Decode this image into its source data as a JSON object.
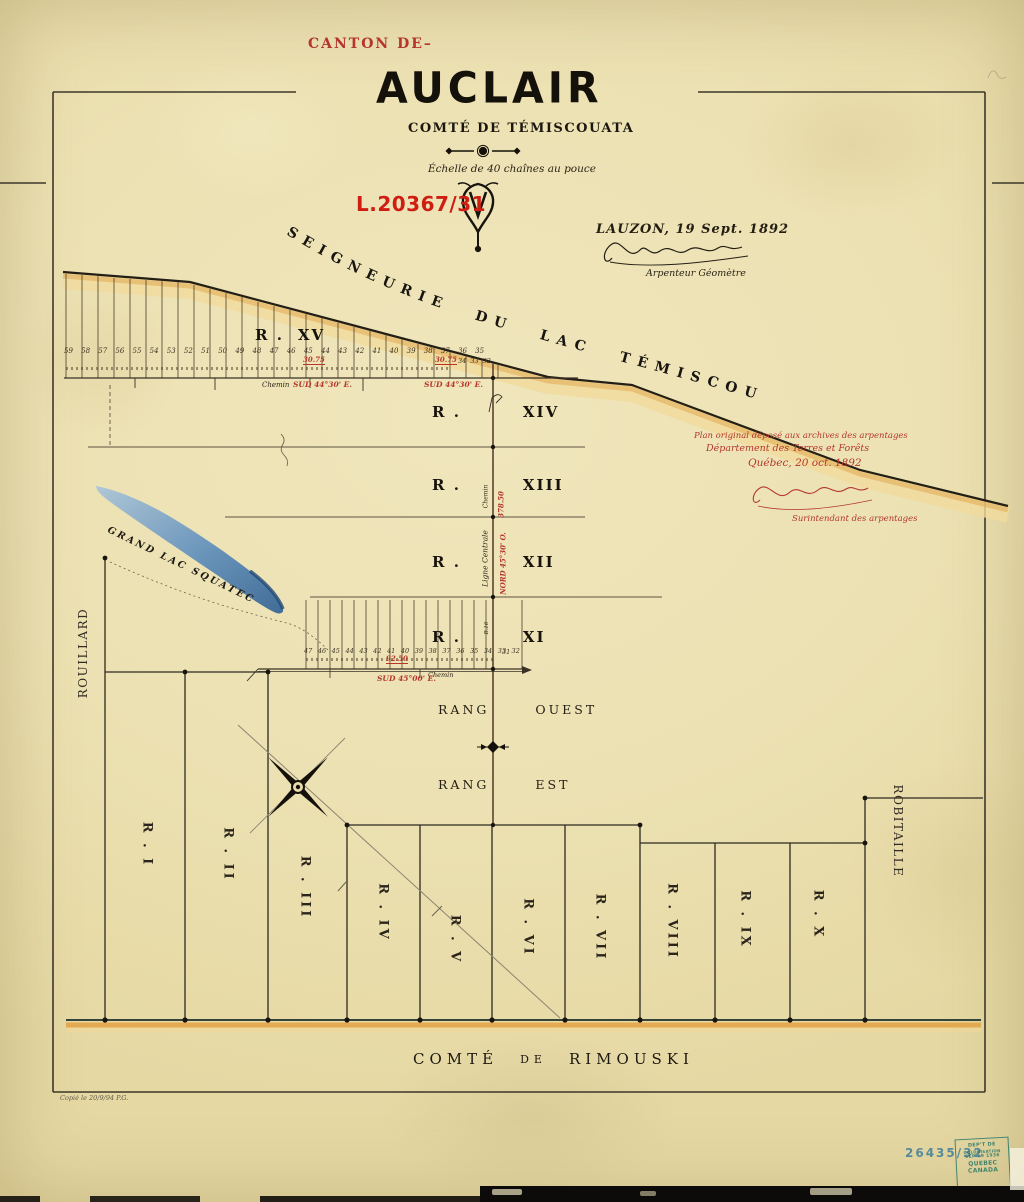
{
  "header": {
    "canton_label": "CANTON DE–",
    "name": "AUCLAIR",
    "county": "COMTÉ DE TÉMISCOUATA",
    "scale": "Échelle de 40 chaînes au pouce",
    "file_number": "L.20367/31",
    "place_date": "LAUZON, 19 Sept. 1892",
    "surveyor_title": "Arpenteur Géomètre"
  },
  "seigneurie_label": "SEIGNEURIE DU LAC TÉMISCOUATA",
  "archive": {
    "line1": "Plan original déposé aux archives des arpentages",
    "line2": "Département des Terres et Forêts",
    "line3": "Québec, 20 oct. 1892",
    "signer_title": "Surintendant des arpentages"
  },
  "upper_ranges": [
    {
      "prefix": "R .",
      "num": "XV"
    },
    {
      "prefix": "R .",
      "num": "XIV"
    },
    {
      "prefix": "R .",
      "num": "XIII"
    },
    {
      "prefix": "R .",
      "num": "XII"
    },
    {
      "prefix": "R .",
      "num": "XI"
    }
  ],
  "lots": {
    "r15_main": "59 58 57 56 55 54 53 52 51 50 49 48 47 46 45 44 43 42 41 40 39 38 37 36 35",
    "r15_tail": "34 33 32",
    "r11_main": "47 46 45 44 43 42 41 40 39 38 37 36 35 34 33 32",
    "r11_tail": "31"
  },
  "annot": {
    "r15_dist": "30.75",
    "r15_bearing": "SUD 44°30' E.",
    "r11_dist": "92.50",
    "r11_bearing": "SUD 45°00' E.",
    "center_dist": "378.50",
    "center_bearing": "NORD 45°30' O.",
    "ligne_centrale": "Ligne Centrale",
    "chemin": "Chemin",
    "b16": "B.16"
  },
  "rang": {
    "w_rang": "RANG",
    "w_ouest": "OUEST",
    "e_rang": "RANG",
    "e_est": "EST"
  },
  "lower_ranges": [
    "R . I",
    "R . II",
    "R . III",
    "R . IV",
    "R . V",
    "R . VI",
    "R . VII",
    "R . VIII",
    "R . IX",
    "R . X"
  ],
  "neighbors": {
    "west": "ROUILLARD",
    "east": "ROBITAILLE"
  },
  "south_county": {
    "w1": "COMTÉ",
    "w2": "DE",
    "w3": "RIMOUSKI"
  },
  "lake_label": "GRAND LAC SQUATEC",
  "stamps": {
    "number": "26435/32",
    "dept": [
      "DEP'T DE",
      "COLONISATION",
      "SEP 19 1936",
      "QUEBEC",
      "CANADA"
    ]
  },
  "copy_note": "Copié le 20/9/94 P.G.",
  "colors": {
    "paper": "#ece1b2",
    "ink": "#211b12",
    "red_ink": "#b5372b",
    "bright_red_stamp": "#cf1d12",
    "boundary_band_yellow": "#f1db9c",
    "boundary_band_orange": "#e0a952",
    "lake_blue": "#2d5f93",
    "registry_stamp_blue": "#47839b",
    "dept_stamp_teal": "#2c7a68"
  }
}
